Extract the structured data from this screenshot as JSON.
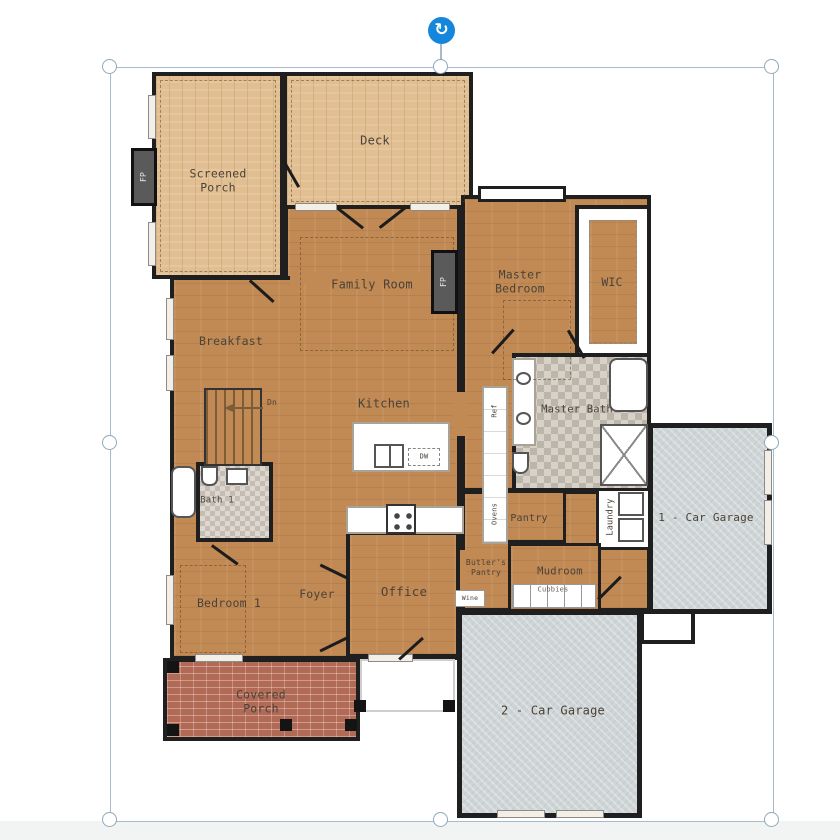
{
  "editor": {
    "selection": {
      "rotate_glyph": "↻"
    }
  },
  "floor_plan": {
    "rooms": {
      "screened_porch": "Screened Porch",
      "deck": "Deck",
      "family_room": "Family Room",
      "master_bedroom": "Master Bedroom",
      "wic": "WIC",
      "breakfast": "Breakfast",
      "kitchen": "Kitchen",
      "master_bath": "Master Bath",
      "bath_1": "Bath 1",
      "bedroom_1": "Bedroom 1",
      "foyer": "Foyer",
      "office": "Office",
      "pantry": "Pantry",
      "butlers_pantry": "Butler's Pantry",
      "mudroom": "Mudroom",
      "laundry": "Laundry",
      "covered_porch": "Covered Porch",
      "garage_1": "1 - Car Garage",
      "garage_2": "2 - Car Garage"
    },
    "annotations": {
      "fireplace": "FP",
      "stairs_down": "Dn",
      "dishwasher": "DW",
      "cubbies": "Cubbies",
      "wine": "Wine",
      "refrigerator": "Ref",
      "ovens": "Ovens"
    },
    "colors": {
      "wall": "#1f1f1f",
      "interior_floor": "#c18a54",
      "porch_floor": "#e2bf92",
      "garage_floor": "#cfd5d6",
      "brick_porch": "#b06a55",
      "bath_tile": "#d7d1c8",
      "selection_outline": "#a6bccb",
      "rotate_handle_blue": "#1486db"
    }
  }
}
